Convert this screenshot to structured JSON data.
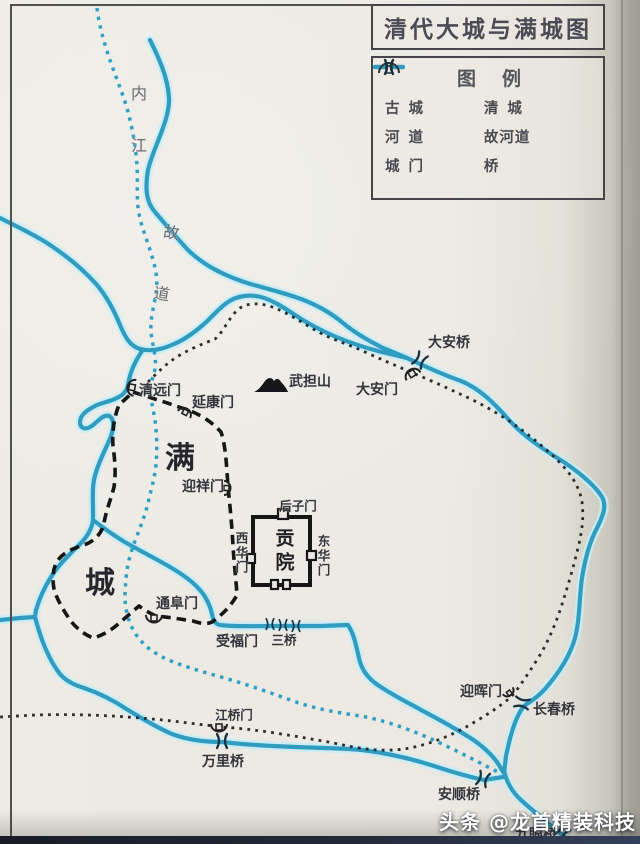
{
  "title": "清代大城与满城图",
  "legend": {
    "heading": "图例",
    "items": [
      {
        "id": "ancient-city-wall",
        "label": "古城",
        "symbol": "dashed-black-line"
      },
      {
        "id": "qing-city-wall",
        "label": "清城",
        "symbol": "dotted-black-line"
      },
      {
        "id": "river-channel",
        "label": "河道",
        "symbol": "solid-blue-line"
      },
      {
        "id": "old-river-channel",
        "label": "故河道",
        "symbol": "dotted-blue-line"
      },
      {
        "id": "city-gate",
        "label": "城门",
        "symbol": "arch-gate-glyph"
      },
      {
        "id": "bridge",
        "label": "桥",
        "symbol": "bridge-glyph"
      }
    ]
  },
  "map": {
    "labels": [
      {
        "id": "neijiang-river",
        "text": "内江"
      },
      {
        "id": "old-course",
        "text": "故道"
      },
      {
        "id": "daan-bridge",
        "text": "大安桥"
      },
      {
        "id": "daan-gate",
        "text": "大安门"
      },
      {
        "id": "wudan-mountain",
        "text": "武担山"
      },
      {
        "id": "qingyuan-gate",
        "text": "清远门"
      },
      {
        "id": "yankang-gate",
        "text": "延康门"
      },
      {
        "id": "man-char",
        "text": "满"
      },
      {
        "id": "cheng-char",
        "text": "城"
      },
      {
        "id": "yingxiang-gate",
        "text": "迎祥门"
      },
      {
        "id": "houzi-gate",
        "text": "后子门"
      },
      {
        "id": "xihua-gate",
        "text": "西华门"
      },
      {
        "id": "donghua-gate",
        "text": "东华门"
      },
      {
        "id": "gongyuan-examination-hall",
        "text": "贡院"
      },
      {
        "id": "tongfu-gate",
        "text": "通阜门"
      },
      {
        "id": "shoufu-gate",
        "text": "受福门"
      },
      {
        "id": "san-bridge",
        "text": "三桥"
      },
      {
        "id": "yinghui-gate",
        "text": "迎晖门"
      },
      {
        "id": "changchun-bridge",
        "text": "长春桥"
      },
      {
        "id": "jiangqiao-gate",
        "text": "江桥门"
      },
      {
        "id": "wanli-bridge",
        "text": "万里桥"
      },
      {
        "id": "anshun-bridge",
        "text": "安顺桥"
      },
      {
        "id": "jiuyan-bridge",
        "text": "九眼桥"
      }
    ]
  },
  "watermark": {
    "text": "头条 @龙首精装科技"
  },
  "colors": {
    "paper": "#eae8e1",
    "river": "#2f9cc0",
    "river_halo": "#c8ecf6",
    "old_river_dots": "#2f9fc4",
    "ancient_wall": "#161616",
    "qing_wall": "#2c2c2c",
    "ink_text": "#34343c",
    "watermark_text": "#ffffff",
    "photo_edge": "#222a38"
  }
}
